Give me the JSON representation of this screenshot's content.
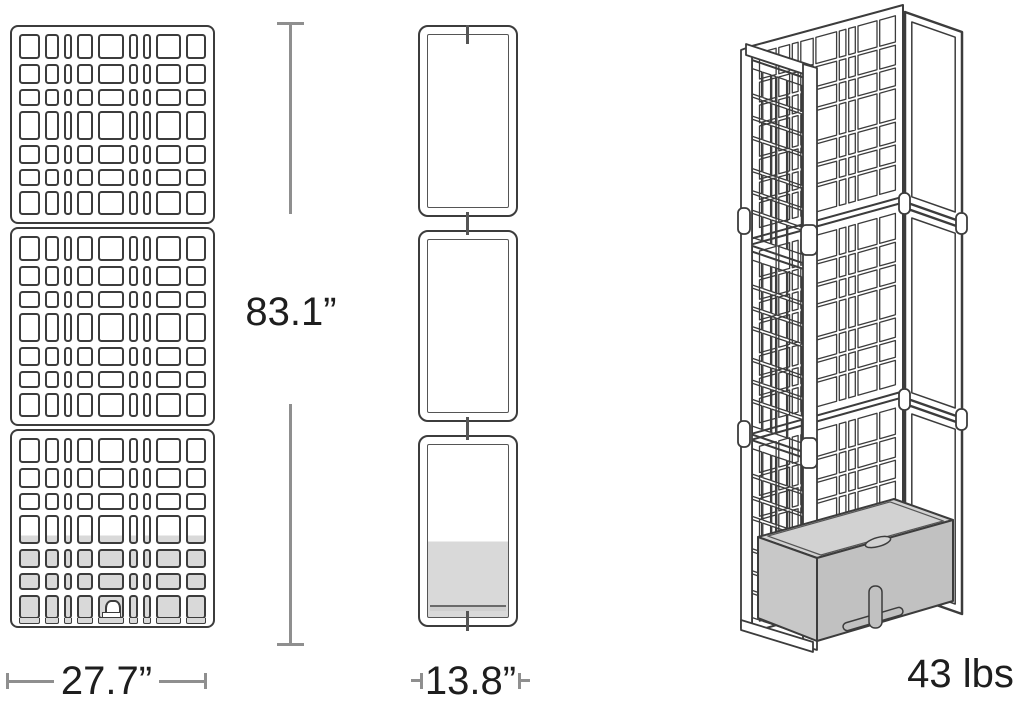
{
  "diagram": {
    "description": "Three-view dimension drawing of a modular lattice privacy screen tower with planter base",
    "labels": {
      "height": "83.1”",
      "width": "27.7”",
      "depth": "13.8”",
      "weight": "43 lbs"
    },
    "views": [
      {
        "id": "front",
        "name": "front-view"
      },
      {
        "id": "side",
        "name": "side-view"
      },
      {
        "id": "perspective",
        "name": "perspective-view"
      }
    ],
    "panel": {
      "modules": 3,
      "columns": [
        2.0,
        1.3,
        0.7,
        1.5,
        2.5,
        0.8,
        0.8,
        2.3,
        1.9
      ],
      "rows": [
        2.0,
        1.5,
        1.35,
        2.3,
        1.5,
        1.3,
        1.9
      ],
      "left_face_columns": [
        1.9,
        1.2,
        0.6,
        1.5,
        2.1,
        0.8
      ],
      "planter_fill_start": 0.56
    },
    "colors": {
      "line": "#3c3c3c",
      "line_soft": "#555555",
      "panel_fill": "#ffffff",
      "planter_gray": "#d9d9d9",
      "planter_top": "#d2d2d2",
      "planter_front_left": "#c8c8c8",
      "planter_front_right": "#c1c1c1",
      "dim_gray": "#8f8f8f",
      "text": "#1e1e1e"
    }
  }
}
